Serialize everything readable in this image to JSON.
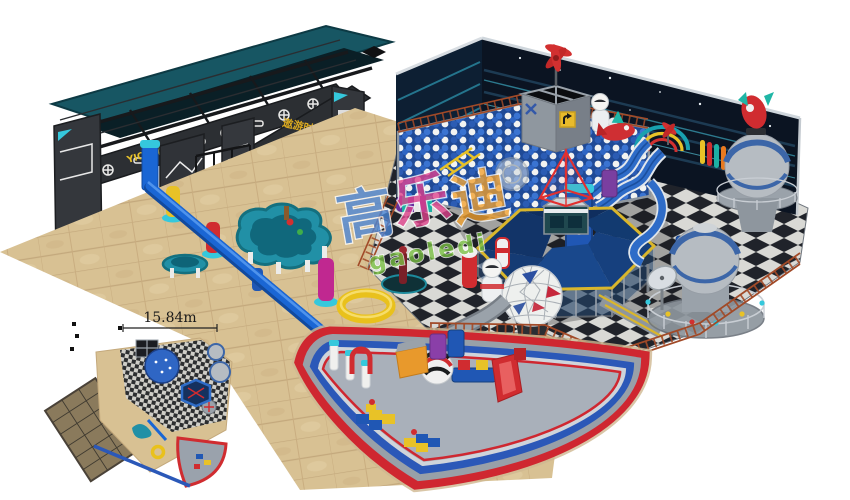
{
  "meta": {
    "description": "3D rendering of a space-themed indoor playground: dark entrance gate structure, ball-pit play area with slides, dome towers and rockets, long blue balance beam, fan-shaped toddler soft-play zone, and a small top-view floor plan inset",
    "canvas_width": "850",
    "canvas_height": "500"
  },
  "inset": {
    "dimension_label": "15.84m"
  },
  "gate": {
    "sign_left": "YIQI乐园",
    "sign_right": "遨游时空"
  },
  "watermark": {
    "char1": "高",
    "char1_color": "#4a86d8",
    "char2": "乐",
    "char2_color": "#e0418c",
    "char3": "迪",
    "char3_color": "#f2a12e",
    "latin": "gaoledi",
    "latin_color": "#7ac143"
  },
  "colors": {
    "background": "#ffffff",
    "wall_navy": "#0b1422",
    "wall_streak_cyan": "#3fb0c8",
    "gate_charcoal": "#33363b",
    "gate_roof_teal": "#175663",
    "floor_tan": "#d8c193",
    "checker_dark": "#20232a",
    "checker_light": "#d9d9d5",
    "ballpit_blue": "#1f4a96",
    "fence_rust": "#a14a28",
    "hexagon_canopy": "#16407e",
    "hexagon_trim_yellow": "#d9b62c",
    "dome_grey": "#b6bcc2",
    "dome_band_blue": "#3c66a8",
    "accent_red": "#d02c30",
    "accent_cyan": "#35c8dc",
    "beam_blue": "#1a66d4",
    "fan_border_red": "#cf2730",
    "fan_border_blue": "#2b58b8",
    "fan_floor_grey": "#a9b0ba"
  }
}
